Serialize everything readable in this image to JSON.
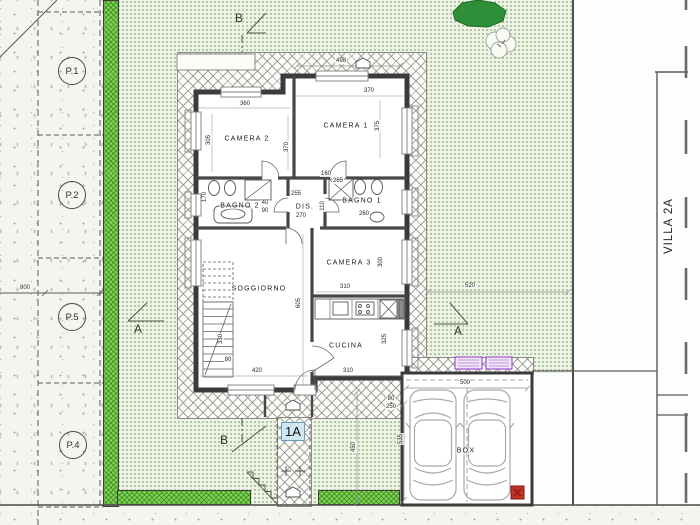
{
  "meta": {
    "villa_label": "VILLA 2A",
    "unit_badge": "1A"
  },
  "rooms": [
    {
      "label": "CAMERA 2",
      "x": 247,
      "y": 139
    },
    {
      "label": "CAMERA 1",
      "x": 346,
      "y": 126
    },
    {
      "label": "BAGNO 2",
      "x": 240,
      "y": 206
    },
    {
      "label": "DIS.",
      "x": 305,
      "y": 207
    },
    {
      "label": "BAGNO 1",
      "x": 362,
      "y": 201
    },
    {
      "label": "SOGGIORNO",
      "x": 259,
      "y": 289
    },
    {
      "label": "CAMERA 3",
      "x": 349,
      "y": 263
    },
    {
      "label": "CUCINA",
      "x": 346,
      "y": 346
    },
    {
      "label": "BOX",
      "x": 466,
      "y": 451
    }
  ],
  "parking": {
    "stalls": [
      {
        "label": "P.1",
        "x": 72,
        "y": 71
      },
      {
        "label": "P.2",
        "x": 72,
        "y": 195
      },
      {
        "label": "P.5",
        "x": 72,
        "y": 317
      },
      {
        "label": "P.4",
        "x": 73,
        "y": 445
      }
    ]
  },
  "section_markers": [
    {
      "label": "B",
      "x": 239,
      "y": 18
    },
    {
      "label": "B",
      "x": 224,
      "y": 440
    },
    {
      "label": "A",
      "x": 138,
      "y": 329
    },
    {
      "label": "A",
      "x": 458,
      "y": 331
    }
  ],
  "dimensions": [
    {
      "text": "498",
      "x": 341,
      "y": 61
    },
    {
      "text": "370",
      "x": 369,
      "y": 91
    },
    {
      "text": "360",
      "x": 245,
      "y": 104
    },
    {
      "text": "305",
      "x": 209,
      "y": 140,
      "rot": true
    },
    {
      "text": "370",
      "x": 287,
      "y": 147,
      "rot": true
    },
    {
      "text": "375",
      "x": 378,
      "y": 126,
      "rot": true
    },
    {
      "text": "170",
      "x": 205,
      "y": 197,
      "rot": true
    },
    {
      "text": "255",
      "x": 296,
      "y": 194
    },
    {
      "text": "270",
      "x": 301,
      "y": 216
    },
    {
      "text": "110",
      "x": 323,
      "y": 206,
      "rot": true
    },
    {
      "text": "160",
      "x": 326,
      "y": 174
    },
    {
      "text": "265",
      "x": 338,
      "y": 181
    },
    {
      "text": "260",
      "x": 364,
      "y": 214
    },
    {
      "text": "40",
      "x": 265,
      "y": 203
    },
    {
      "text": "90",
      "x": 265,
      "y": 211
    },
    {
      "text": "605",
      "x": 299,
      "y": 303,
      "rot": true
    },
    {
      "text": "310",
      "x": 345,
      "y": 287
    },
    {
      "text": "300",
      "x": 381,
      "y": 262,
      "rot": true
    },
    {
      "text": "330",
      "x": 221,
      "y": 339,
      "rot": true
    },
    {
      "text": "80",
      "x": 228,
      "y": 360
    },
    {
      "text": "420",
      "x": 257,
      "y": 371
    },
    {
      "text": "310",
      "x": 348,
      "y": 371
    },
    {
      "text": "325",
      "x": 385,
      "y": 339,
      "rot": true
    },
    {
      "text": "520",
      "x": 470,
      "y": 286
    },
    {
      "text": "500",
      "x": 465,
      "y": 383
    },
    {
      "text": "535",
      "x": 401,
      "y": 439,
      "rot": true
    },
    {
      "text": "450",
      "x": 354,
      "y": 447,
      "rot": true
    },
    {
      "text": "800",
      "x": 25,
      "y": 288
    },
    {
      "text": "80",
      "x": 391,
      "y": 399
    },
    {
      "text": "250",
      "x": 391,
      "y": 407
    }
  ],
  "colors": {
    "wall": "#3b3b3b",
    "garden_bg": "#edf4e3",
    "garden_dot": "#9fb795",
    "hedge_green": "#7fd351",
    "badge_bg": "#cfe7f3",
    "vent_purple": "#8b35c9",
    "extinguisher_red": "#c23326",
    "tree_green": "#2e8f38",
    "sidewalk_bg": "#f4f4f1"
  }
}
